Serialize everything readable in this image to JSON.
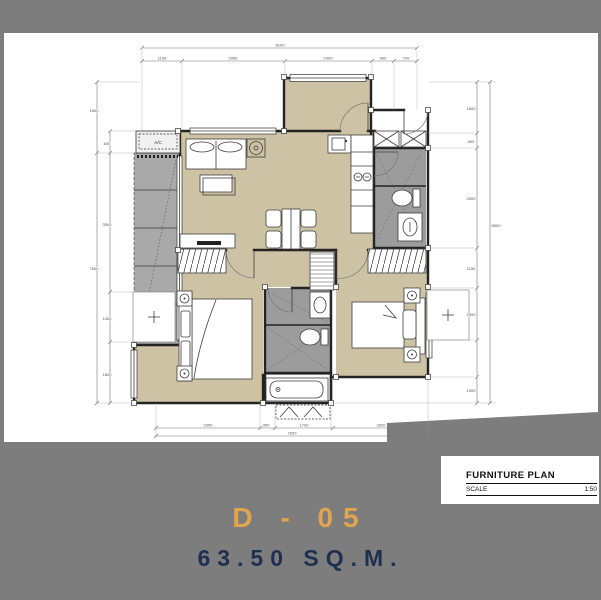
{
  "header": {
    "unit_code": "D - 05",
    "unit_area": "63.50 SQ.M."
  },
  "titleblock": {
    "title": "FURNITURE PLAN",
    "scale_label": "SCALE",
    "scale_value": "1:50"
  },
  "plan": {
    "ac_label": "A/C",
    "dims": {
      "top_total": "8100",
      "top_segments": [
        "1150",
        "2950",
        "2400",
        "900",
        "700"
      ],
      "left_outer_top": "1600",
      "left_outer_bottom": "7600",
      "left_inner": [
        "600",
        "3500",
        "1400",
        "1800"
      ],
      "right_outer_total": "8500",
      "right_inner": [
        "1600",
        "900",
        "2500",
        "1150",
        "1400",
        "1000"
      ],
      "bottom_total": "7600",
      "bottom_segments": [
        "2950",
        "350",
        "1700",
        "2600"
      ]
    }
  },
  "colors": {
    "canvas_gray": "#7d7d7d",
    "sheet_white": "#ffffff",
    "floor_tan": "#cdc3a4",
    "bathroom_gray": "#9c9c9c",
    "balcony_gray": "#a9a9a9",
    "wall_dark": "#232323",
    "unit_code_accent": "#e2a54f",
    "unit_area_navy": "#1e3050"
  }
}
